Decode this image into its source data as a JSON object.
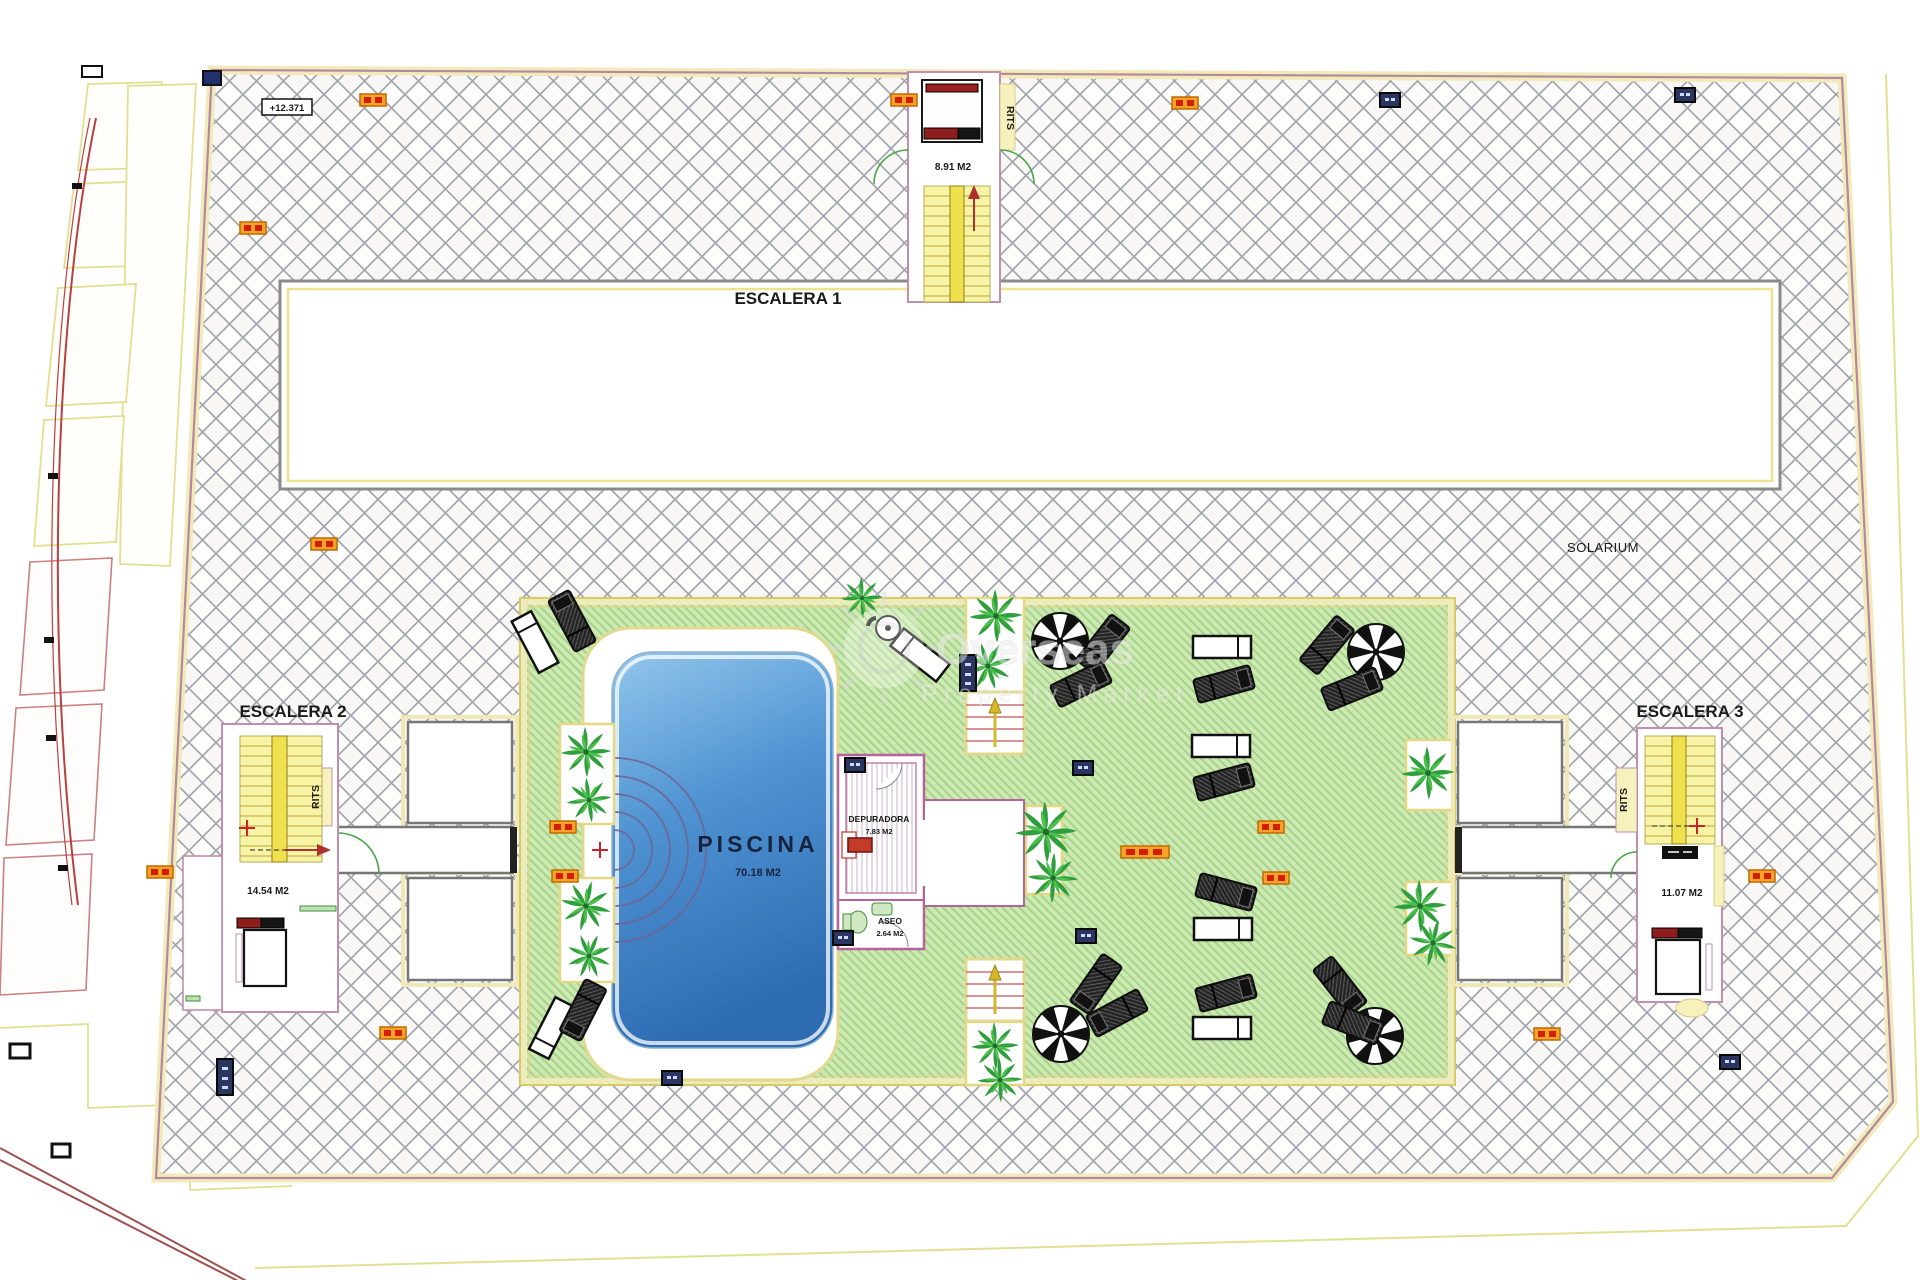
{
  "plan": {
    "rits": "RITS",
    "level_marker": "+12.371",
    "solarium": "SOLARIUM",
    "escalera1": {
      "label": "ESCALERA 1",
      "area": "8.91 M2"
    },
    "escalera2": {
      "label": "ESCALERA 2",
      "area": "14.54 M2"
    },
    "escalera3": {
      "label": "ESCALERA 3",
      "area": "11.07 M2"
    },
    "pool": {
      "label": "PISCINA",
      "area": "70.18 M2"
    },
    "depuradora": {
      "label": "DEPURADORA",
      "area": "7.83 M2"
    },
    "aseo": {
      "label": "ASEO",
      "area": "2.64 M2"
    }
  },
  "watermark": {
    "line1": "Overseas",
    "line2": "Property Market"
  },
  "colors": {
    "deck_green": "#cfe9b4",
    "pool_blue": "#4f93d2",
    "wall_pink": "#b4649a",
    "boundary_yellow": "#f1ebbb",
    "marker_orange": "#f7a329",
    "marker_navy": "#2a3560",
    "stair_yellow": "#f8f4a6",
    "accent_red": "#c0392b"
  },
  "placements": {
    "palm": [
      [
        586,
        752,
        0,
        0.9
      ],
      [
        589,
        800,
        40,
        0.8
      ],
      [
        586,
        906,
        15,
        0.9
      ],
      [
        589,
        956,
        70,
        0.8
      ],
      [
        996,
        616,
        0,
        0.95
      ],
      [
        988,
        666,
        30,
        0.85
      ],
      [
        862,
        598,
        0,
        0.75
      ],
      [
        1046,
        832,
        0,
        1.1
      ],
      [
        1053,
        878,
        50,
        0.9
      ],
      [
        1428,
        773,
        0,
        0.95
      ],
      [
        1420,
        906,
        0,
        0.95
      ],
      [
        1433,
        943,
        60,
        0.85
      ],
      [
        995,
        1046,
        0,
        0.85
      ],
      [
        1000,
        1080,
        45,
        0.8
      ]
    ],
    "parasol": [
      [
        1060,
        641
      ],
      [
        1376,
        652
      ],
      [
        1061,
        1034
      ],
      [
        1375,
        1036
      ]
    ],
    "lounger_white": [
      [
        535,
        642,
        -28
      ],
      [
        920,
        655,
        -52
      ],
      [
        552,
        1028,
        207
      ],
      [
        1222,
        647,
        90
      ],
      [
        1221,
        746,
        90
      ],
      [
        1223,
        929,
        90
      ],
      [
        1222,
        1028,
        90
      ]
    ],
    "lounger_dark": [
      [
        572,
        621,
        -28
      ],
      [
        583,
        1010,
        207
      ],
      [
        1103,
        644,
        38
      ],
      [
        1081,
        684,
        64
      ],
      [
        1327,
        645,
        40
      ],
      [
        1352,
        689,
        68
      ],
      [
        1096,
        984,
        215
      ],
      [
        1117,
        1013,
        242
      ],
      [
        1340,
        986,
        142
      ],
      [
        1353,
        1023,
        112
      ],
      [
        1224,
        684,
        75
      ],
      [
        1224,
        782,
        75
      ],
      [
        1226,
        892,
        105
      ],
      [
        1226,
        993,
        75
      ]
    ],
    "table": [
      [
        888,
        628,
        0
      ]
    ],
    "steps": [
      [
        995,
        723
      ],
      [
        995,
        990
      ]
    ],
    "marker_orange": [
      [
        373,
        100
      ],
      [
        904,
        100
      ],
      [
        1185,
        103
      ],
      [
        253,
        228
      ],
      [
        324,
        544
      ],
      [
        160,
        872
      ],
      [
        563,
        827
      ],
      [
        565,
        876
      ],
      [
        1271,
        827
      ],
      [
        1276,
        878
      ],
      [
        1762,
        876
      ],
      [
        1547,
        1034
      ],
      [
        393,
        1033
      ]
    ],
    "marker_orange_long": [
      [
        1145,
        852
      ]
    ],
    "marker_navy": [
      [
        1685,
        95
      ],
      [
        1390,
        100
      ],
      [
        672,
        1078
      ],
      [
        1730,
        1062
      ],
      [
        1083,
        768
      ],
      [
        1086,
        936
      ],
      [
        855,
        765
      ],
      [
        843,
        938
      ]
    ],
    "marker_navy_tall": [
      [
        225,
        1077
      ],
      [
        968,
        673
      ]
    ],
    "red_cross": [
      [
        600,
        850
      ],
      [
        247,
        828
      ],
      [
        1697,
        826
      ]
    ],
    "red_arrow": [
      [
        974,
        205,
        0
      ],
      [
        311,
        850,
        90
      ]
    ]
  }
}
